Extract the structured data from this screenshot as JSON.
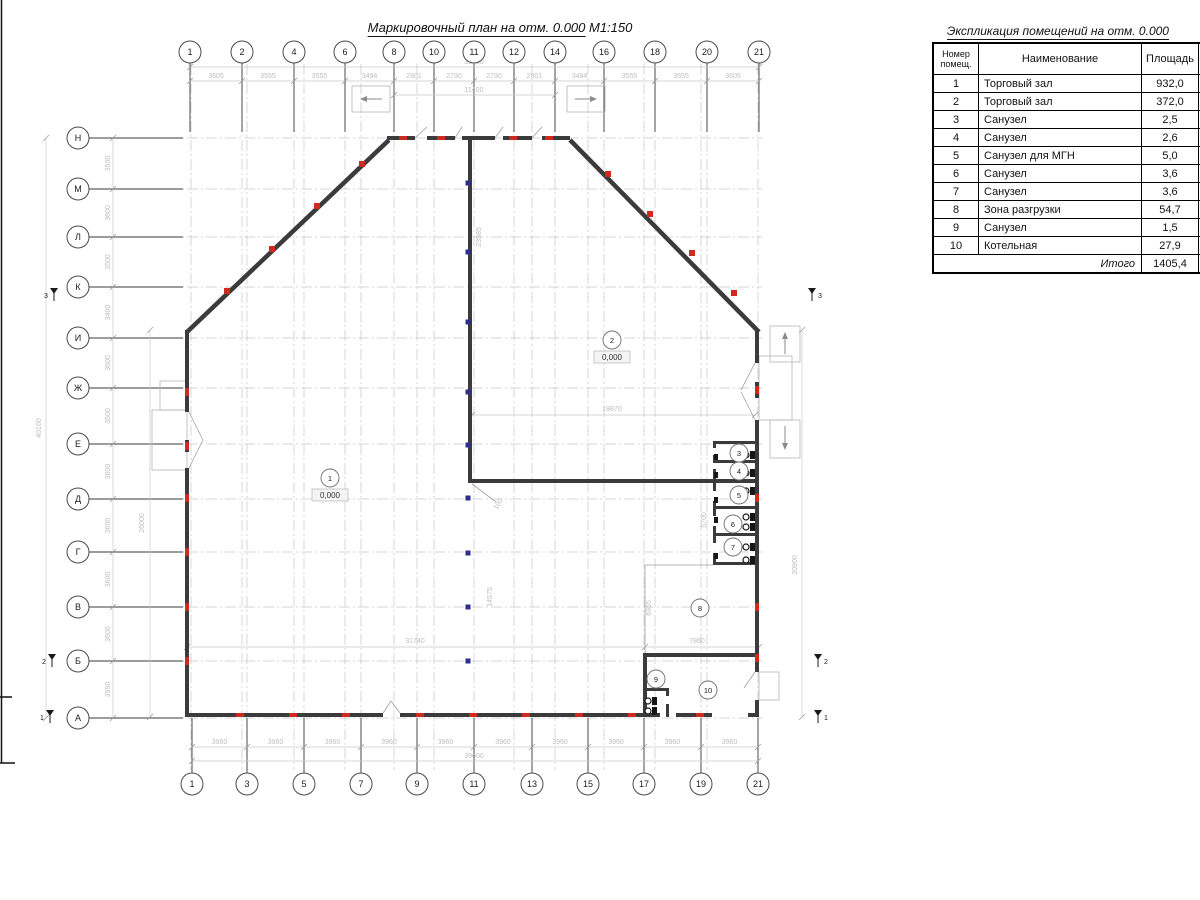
{
  "plan_title": {
    "text": "Маркировочный план на отм. 0.000",
    "scale": " М1:150"
  },
  "schedule": {
    "title": "Экспликация помещений на отм. 0.000",
    "columns": [
      "Номер помещ.",
      "Наименование",
      "Площадь",
      "Кат. пом."
    ],
    "rows": [
      [
        "1",
        "Торговый зал",
        "932,0",
        ""
      ],
      [
        "2",
        "Торговый зал",
        "372,0",
        ""
      ],
      [
        "3",
        "Санузел",
        "2,5",
        ""
      ],
      [
        "4",
        "Санузел",
        "2,6",
        ""
      ],
      [
        "5",
        "Санузел для МГН",
        "5,0",
        ""
      ],
      [
        "6",
        "Санузел",
        "3,6",
        ""
      ],
      [
        "7",
        "Санузел",
        "3,6",
        ""
      ],
      [
        "8",
        "Зона разгрузки",
        "54,7",
        ""
      ],
      [
        "9",
        "Санузел",
        "1,5",
        ""
      ],
      [
        "10",
        "Котельная",
        "27,9",
        ""
      ]
    ],
    "total_label": "Итого",
    "total_value": "1405,4"
  },
  "plan": {
    "colors": {
      "wall": "#3b3b3b",
      "grid": "#c6c6c6",
      "dimline": "#c9c9c9",
      "dimtext": "#bdbdbd",
      "marker": "#cf2a1f",
      "column": "#2d2d8f",
      "thin": "#b5b5b5",
      "axis": "#3a3a3a",
      "fixture": "#161616",
      "frame": "#111111"
    },
    "axes_top": {
      "cy": 52,
      "r": 11,
      "labels": [
        [
          "1",
          190
        ],
        [
          "2",
          242
        ],
        [
          "4",
          294
        ],
        [
          "6",
          345
        ],
        [
          "8",
          394
        ],
        [
          "10",
          434
        ],
        [
          "11",
          474
        ],
        [
          "12",
          514
        ],
        [
          "14",
          555
        ],
        [
          "16",
          604
        ],
        [
          "18",
          655
        ],
        [
          "20",
          707
        ],
        [
          "21",
          759
        ]
      ]
    },
    "axes_bottom": {
      "cy": 784,
      "r": 11,
      "labels": [
        [
          "1",
          192
        ],
        [
          "3",
          247
        ],
        [
          "5",
          304
        ],
        [
          "7",
          361
        ],
        [
          "9",
          417
        ],
        [
          "11",
          474
        ],
        [
          "13",
          532
        ],
        [
          "15",
          588
        ],
        [
          "17",
          644
        ],
        [
          "19",
          701
        ],
        [
          "21",
          758
        ]
      ]
    },
    "axes_left": {
      "cx": 78,
      "r": 11,
      "labels": [
        [
          "Н",
          138
        ],
        [
          "М",
          189
        ],
        [
          "Л",
          237
        ],
        [
          "К",
          287
        ],
        [
          "И",
          338
        ],
        [
          "Ж",
          388
        ],
        [
          "Е",
          444
        ],
        [
          "Д",
          499
        ],
        [
          "Г",
          552
        ],
        [
          "В",
          607
        ],
        [
          "Б",
          661
        ],
        [
          "А",
          718
        ]
      ]
    },
    "dims": {
      "top_chain": [
        "3605",
        "3555",
        "3555",
        "3494",
        "2801",
        "2790",
        "2790",
        "2801",
        "3494",
        "3555",
        "3555",
        "3605"
      ],
      "bottom_chain": [
        "3960",
        "3960",
        "3960",
        "3960",
        "3960",
        "3960",
        "3960",
        "3960",
        "3960",
        "3960"
      ],
      "left_chain": [
        "3500",
        "3600",
        "3500",
        "3400",
        "3600",
        "3500",
        "3600",
        "3600",
        "3600",
        "3600",
        "3950"
      ],
      "texts": [
        {
          "t": "39600",
          "x": 474,
          "y": 64
        },
        {
          "t": "11400",
          "x": 474,
          "y": 92
        },
        {
          "t": "39600",
          "x": 474,
          "y": 758
        },
        {
          "t": "40160",
          "x": 41,
          "y": 428,
          "r": -90
        },
        {
          "t": "26000",
          "x": 144,
          "y": 523,
          "r": -90
        },
        {
          "t": "23985",
          "x": 481,
          "y": 237,
          "r": -90
        },
        {
          "t": "19870",
          "x": 612,
          "y": 411
        },
        {
          "t": "31740",
          "x": 415,
          "y": 643
        },
        {
          "t": "7860",
          "x": 697,
          "y": 643
        },
        {
          "t": "14575",
          "x": 492,
          "y": 597,
          "r": -90
        },
        {
          "t": "100",
          "x": 500,
          "y": 505,
          "r": -60
        },
        {
          "t": "6955",
          "x": 651,
          "y": 608,
          "r": -90
        },
        {
          "t": "5700",
          "x": 706,
          "y": 520,
          "r": -90
        },
        {
          "t": "20900",
          "x": 797,
          "y": 565,
          "r": -90
        }
      ]
    },
    "dim_lines": [
      [
        190,
        67,
        759,
        67
      ],
      [
        190,
        81,
        759,
        81
      ],
      [
        394,
        95,
        555,
        95
      ],
      [
        192,
        747,
        758,
        747
      ],
      [
        192,
        761,
        758,
        761
      ],
      [
        113,
        138,
        113,
        718
      ],
      [
        46,
        138,
        46,
        718
      ],
      [
        150,
        330,
        150,
        717
      ],
      [
        802,
        330,
        802,
        717
      ],
      [
        472,
        415,
        755,
        415
      ],
      [
        187,
        647,
        759,
        647
      ]
    ],
    "dim_ticks": [
      [
        187,
        647
      ],
      [
        645,
        647
      ],
      [
        759,
        647
      ],
      [
        472,
        415
      ],
      [
        755,
        415
      ],
      [
        394,
        95
      ],
      [
        555,
        95
      ],
      [
        190,
        67
      ],
      [
        759,
        67
      ],
      [
        150,
        330
      ],
      [
        150,
        717
      ],
      [
        802,
        330
      ],
      [
        802,
        717
      ],
      [
        192,
        761
      ],
      [
        758,
        761
      ],
      [
        46,
        138
      ],
      [
        46,
        718
      ]
    ],
    "grid": {
      "v_xs": [
        191,
        242,
        247,
        294,
        304,
        345,
        361,
        394,
        417,
        434,
        474,
        514,
        532,
        555,
        588,
        604,
        644,
        655,
        701,
        707,
        758
      ],
      "v_y1": 64,
      "v_y2": 770,
      "h_ys": [
        138,
        189,
        237,
        287,
        338,
        388,
        444,
        499,
        552,
        607,
        661,
        718
      ],
      "h_x1": 92,
      "h_x2": 762
    },
    "walls_rect": [
      [
        387,
        136,
        28,
        4
      ],
      [
        427,
        136,
        28,
        4
      ],
      [
        462,
        136,
        33,
        4
      ],
      [
        503,
        136,
        29,
        4
      ],
      [
        542,
        136,
        28,
        4
      ],
      [
        468,
        138,
        4,
        345
      ],
      [
        468,
        479,
        291,
        4
      ],
      [
        185,
        330,
        4,
        82
      ],
      [
        185,
        440,
        4,
        12
      ],
      [
        185,
        468,
        4,
        249
      ],
      [
        187,
        713,
        196,
        4
      ],
      [
        400,
        713,
        260,
        4
      ],
      [
        676,
        713,
        36,
        4
      ],
      [
        748,
        713,
        11,
        4
      ],
      [
        755,
        330,
        4,
        33
      ],
      [
        755,
        382,
        4,
        16
      ],
      [
        755,
        420,
        4,
        252
      ],
      [
        755,
        700,
        4,
        17
      ],
      [
        713,
        441,
        46,
        3
      ],
      [
        713,
        460,
        46,
        3
      ],
      [
        713,
        506,
        46,
        3
      ],
      [
        713,
        533,
        46,
        3
      ],
      [
        713,
        562,
        46,
        3
      ],
      [
        713,
        441,
        3,
        7
      ],
      [
        713,
        455,
        3,
        7
      ],
      [
        713,
        469,
        3,
        12
      ],
      [
        713,
        483,
        3,
        8
      ],
      [
        713,
        501,
        3,
        15
      ],
      [
        713,
        526,
        3,
        17
      ],
      [
        713,
        553,
        3,
        11
      ],
      [
        643,
        653,
        116,
        4
      ],
      [
        643,
        653,
        4,
        64
      ],
      [
        643,
        688,
        26,
        3
      ],
      [
        666,
        688,
        3,
        8
      ],
      [
        666,
        704,
        3,
        13
      ]
    ],
    "walls_line": [
      [
        187,
        332,
        389,
        140
      ],
      [
        570,
        140,
        759,
        332
      ]
    ],
    "thin_rects": [
      [
        352,
        86,
        38,
        26
      ],
      [
        567,
        86,
        38,
        26
      ],
      [
        770,
        326,
        30,
        36
      ],
      [
        759,
        356,
        33,
        64
      ],
      [
        770,
        420,
        30,
        38
      ],
      [
        160,
        381,
        27,
        29
      ],
      [
        152,
        410,
        35,
        60
      ],
      [
        759,
        672,
        20,
        28
      ]
    ],
    "thin_lines": [
      [
        645,
        565,
        645,
        653
      ],
      [
        645,
        565,
        713,
        565
      ],
      [
        189,
        412,
        203,
        440
      ],
      [
        189,
        468,
        203,
        440
      ],
      [
        755,
        363,
        741,
        390
      ],
      [
        755,
        420,
        741,
        392
      ],
      [
        383,
        713,
        391,
        701
      ],
      [
        400,
        713,
        391,
        701
      ],
      [
        415,
        138,
        427,
        127
      ],
      [
        455,
        138,
        462,
        127
      ],
      [
        495,
        138,
        503,
        127
      ],
      [
        532,
        138,
        542,
        127
      ],
      [
        755,
        672,
        744,
        688
      ],
      [
        472,
        484,
        496,
        502
      ]
    ],
    "arrows": [
      [
        382,
        99,
        360,
        99
      ],
      [
        575,
        99,
        597,
        99
      ],
      [
        785,
        354,
        785,
        332
      ],
      [
        785,
        426,
        785,
        450
      ]
    ],
    "markers_red": [
      [
        403,
        138,
        0
      ],
      [
        441,
        138,
        0
      ],
      [
        513,
        138,
        0
      ],
      [
        549,
        138,
        0
      ],
      [
        227,
        291,
        2
      ],
      [
        272,
        249,
        2
      ],
      [
        317,
        206,
        2
      ],
      [
        362,
        164,
        2
      ],
      [
        608,
        174,
        2
      ],
      [
        650,
        214,
        2
      ],
      [
        692,
        253,
        2
      ],
      [
        734,
        293,
        2
      ],
      [
        187,
        392,
        1
      ],
      [
        187,
        446,
        1
      ],
      [
        187,
        498,
        1
      ],
      [
        187,
        552,
        1
      ],
      [
        187,
        607,
        1
      ],
      [
        187,
        661,
        1
      ],
      [
        757,
        390,
        1
      ],
      [
        757,
        498,
        1
      ],
      [
        757,
        607,
        1
      ],
      [
        757,
        658,
        1
      ],
      [
        240,
        715,
        0
      ],
      [
        293,
        715,
        0
      ],
      [
        346,
        715,
        0
      ],
      [
        420,
        715,
        0
      ],
      [
        473,
        715,
        0
      ],
      [
        526,
        715,
        0
      ],
      [
        579,
        715,
        0
      ],
      [
        632,
        715,
        0
      ],
      [
        700,
        715,
        0
      ]
    ],
    "columns_blue": {
      "x": 468,
      "ys": [
        183,
        252,
        322,
        392,
        445,
        498,
        553,
        607,
        661
      ],
      "size": 5
    },
    "toilets": [
      [
        746,
        455
      ],
      [
        746,
        473
      ],
      [
        746,
        491
      ],
      [
        746,
        517
      ],
      [
        746,
        527
      ],
      [
        746,
        547
      ],
      [
        746,
        560
      ],
      [
        648,
        701
      ],
      [
        648,
        711
      ]
    ],
    "sinks": [
      [
        716,
        457
      ],
      [
        716,
        475
      ],
      [
        716,
        500
      ],
      [
        716,
        520
      ],
      [
        716,
        556
      ]
    ],
    "rooms": [
      {
        "n": "1",
        "x": 330,
        "y": 478,
        "e": "0,000"
      },
      {
        "n": "2",
        "x": 612,
        "y": 340,
        "e": "0,000"
      },
      {
        "n": "3",
        "x": 739,
        "y": 453
      },
      {
        "n": "4",
        "x": 739,
        "y": 471
      },
      {
        "n": "5",
        "x": 739,
        "y": 495
      },
      {
        "n": "6",
        "x": 733,
        "y": 524
      },
      {
        "n": "7",
        "x": 733,
        "y": 547
      },
      {
        "n": "8",
        "x": 700,
        "y": 608
      },
      {
        "n": "9",
        "x": 656,
        "y": 679
      },
      {
        "n": "10",
        "x": 708,
        "y": 690
      }
    ],
    "section_marks": [
      {
        "n": "3",
        "x": 54,
        "y": 295,
        "side": "l"
      },
      {
        "n": "3",
        "x": 812,
        "y": 295,
        "side": "r"
      },
      {
        "n": "2",
        "x": 52,
        "y": 661,
        "side": "l"
      },
      {
        "n": "2",
        "x": 818,
        "y": 661,
        "side": "r"
      },
      {
        "n": "1",
        "x": 50,
        "y": 717,
        "side": "l"
      },
      {
        "n": "1",
        "x": 818,
        "y": 717,
        "side": "r"
      }
    ],
    "frame_lines": [
      [
        1.5,
        0,
        1.5,
        763
      ],
      [
        0,
        697,
        12,
        697
      ],
      [
        0,
        763,
        15,
        763
      ]
    ]
  }
}
